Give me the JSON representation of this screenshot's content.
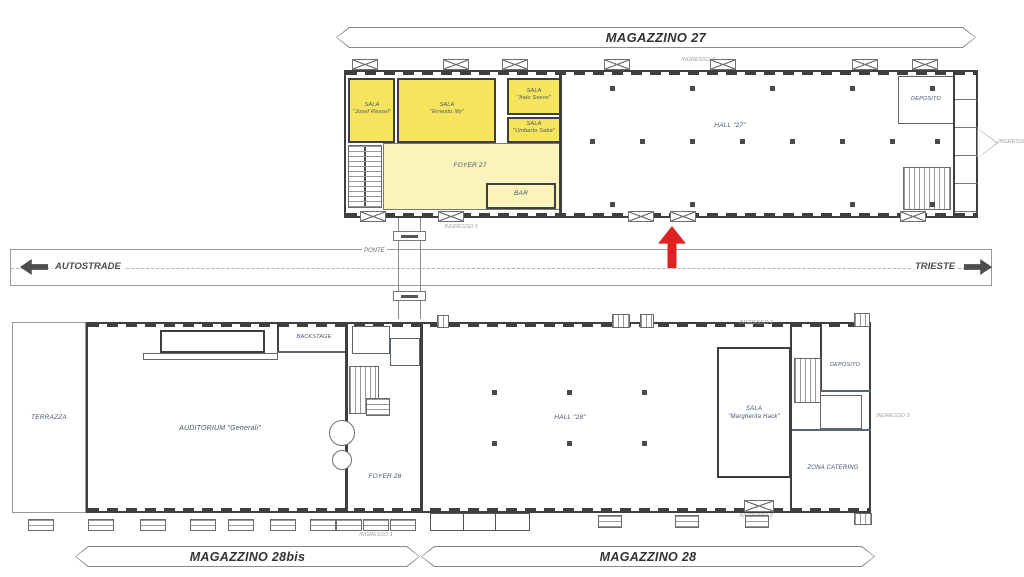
{
  "banners": {
    "magazzino_27": "MAGAZZINO 27",
    "magazzino_28bis": "MAGAZZINO 28bis",
    "magazzino_28": "MAGAZZINO 28"
  },
  "road": {
    "autostrade": "AUTOSTRADE",
    "trieste": "TRIESTE",
    "ponte": "PONTE"
  },
  "building_27": {
    "sala_ressel": {
      "line1": "SALA",
      "line2": "\"Josef Ressel\""
    },
    "sala_illy": {
      "line1": "SALA",
      "line2": "\"Ernesto Illy\""
    },
    "sala_svevo": {
      "line1": "SALA",
      "line2": "\"Italo Svevo\""
    },
    "sala_saba": {
      "line1": "SALA",
      "line2": "\"Umberto Saba\""
    },
    "foyer": "FOYER 27",
    "bar": "BAR",
    "hall": "HALL \"27\"",
    "deposito": "DEPOSITO"
  },
  "building_28": {
    "terrazza": "TERRAZZA",
    "backstage": "BACKSTAGE",
    "auditorium": "AUDITORIUM \"Generali\"",
    "foyer": "FOYER 28",
    "hall": "HALL \"28\"",
    "sala_hack": {
      "line1": "SALA",
      "line2": "\"Margherita Hack\""
    },
    "deposito": "DEPOSITO",
    "zona_catering": "ZONA CATERING"
  },
  "entrances": {
    "e1": "INGRESSO 1",
    "e2": "INGRESSO 2",
    "e3": "INGRESSO 3",
    "e4": "INGRESSO 4",
    "e5": "INGRESSO 5",
    "e6": "INGRESSO 6",
    "e7": "INGRESSO 7"
  },
  "colors": {
    "highlight_strong": "#F5E45C",
    "highlight_light": "#FAF3BC",
    "wall": "#3F3F3F",
    "label": "#44546A",
    "marker_red": "#E02222"
  }
}
